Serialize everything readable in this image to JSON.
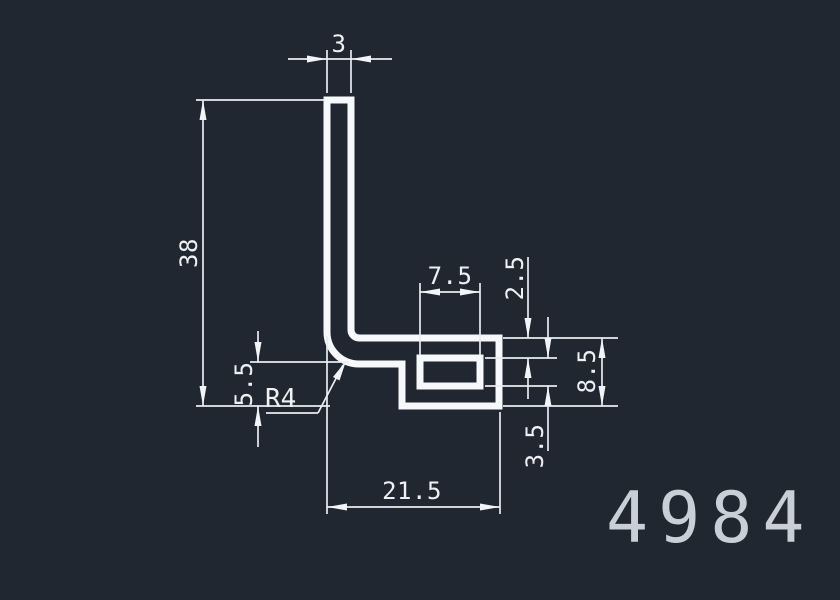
{
  "drawing": {
    "title": "extrusion-profile-cross-section",
    "part_number": "4984",
    "colors": {
      "background": "#212730",
      "profile_line": "#f6f8fa",
      "dimension_line": "#e9edf2",
      "text": "#eef0f3",
      "part_number_text": "#c9cfd7"
    },
    "dims": {
      "leg_width": "3",
      "total_height": "38",
      "hole_width": "7.5",
      "top_wall": "2.5",
      "hole_height": "3.5",
      "right_height": "8.5",
      "step_height": "5.5",
      "bottom_width": "21.5",
      "corner_radius": "R4"
    }
  }
}
